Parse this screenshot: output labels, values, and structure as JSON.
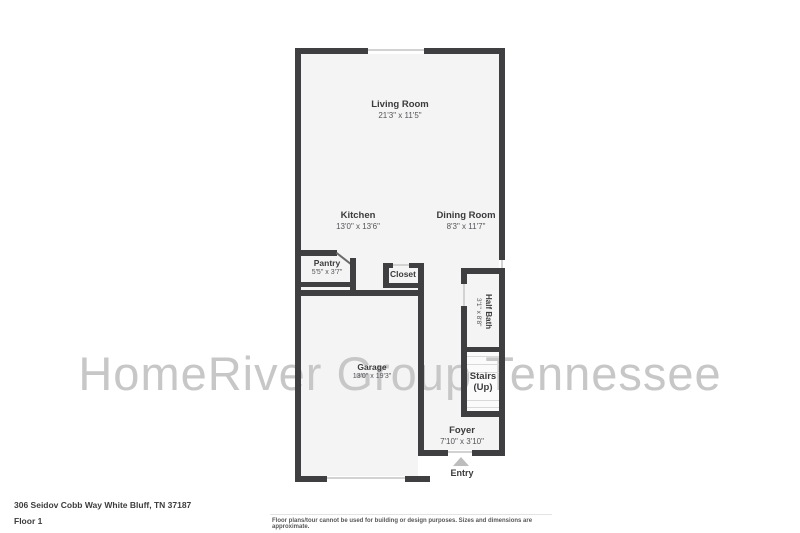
{
  "meta": {
    "address": "306 Seidov Cobb Way White Bluff, TN 37187",
    "floor": "Floor 1",
    "disclaimer": "Floor plans/tour cannot be used for building or design purposes. Sizes and dimensions are approximate."
  },
  "watermark": "HomeRiver Group Tennessee",
  "rooms": {
    "living_room": {
      "name": "Living Room",
      "dims": "21'3\" x 11'5\""
    },
    "kitchen": {
      "name": "Kitchen",
      "dims": "13'0\" x 13'6\""
    },
    "dining_room": {
      "name": "Dining Room",
      "dims": "8'3\" x 11'7\""
    },
    "pantry": {
      "name": "Pantry",
      "dims": "5'5\" x 3'7\""
    },
    "closet": {
      "name": "Closet"
    },
    "half_bath": {
      "name": "Half Bath",
      "dims": "3'1\" x 8'8\""
    },
    "stairs": {
      "name": "Stairs",
      "sub": "(Up)"
    },
    "garage": {
      "name": "Garage",
      "dims": "13'0\" x 19'3\""
    },
    "foyer": {
      "name": "Foyer",
      "dims": "7'10\" x 3'10\""
    }
  },
  "entry": {
    "label": "Entry"
  },
  "colors": {
    "wall": "#3f3f41",
    "room_fill": "#f4f4f4",
    "watermark": "#c7c7c7",
    "label_text": "#3b3b3d",
    "entry_arrow": "#bdbdbd"
  }
}
